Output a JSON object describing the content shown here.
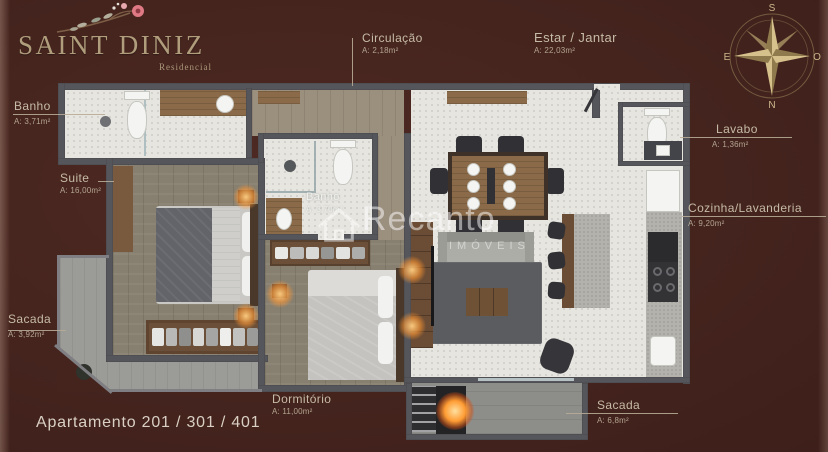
{
  "logo": {
    "title": "SAINT DINIZ",
    "subtitle": "Residencial"
  },
  "compass": {
    "top": "S",
    "left": "E",
    "right": "O",
    "bottom": "N"
  },
  "watermark": {
    "brand": "Recanto",
    "subbrand": "IMÓVEIS"
  },
  "apartment": {
    "label": "Apartamento 201 / 301 / 401"
  },
  "rooms": {
    "banho_suite": {
      "name": "Banho",
      "area": "A: 3,71m²"
    },
    "suite": {
      "name": "Suite",
      "area": "A: 16,00m²"
    },
    "sacada_esquerda": {
      "name": "Sacada",
      "area": "A: 3,92m²"
    },
    "circulacao": {
      "name": "Circulação",
      "area": "A: 2,18m²"
    },
    "estar_jantar": {
      "name": "Estar / Jantar",
      "area": "A: 22,03m²"
    },
    "lavabo": {
      "name": "Lavabo",
      "area": "A: 1,36m²"
    },
    "cozinha_lavanderia": {
      "name": "Cozinha/Lavanderia",
      "area": "A: 9,20m²"
    },
    "banho_social": {
      "name": "Banho",
      "area": "A: 3,70m²"
    },
    "dormitorio": {
      "name": "Dormitório",
      "area": "A: 11,00m²"
    },
    "sacada_churrasqueira": {
      "name": "Sacada",
      "area": "A: 6,8m²"
    }
  },
  "colors": {
    "background": "#45241E",
    "accent_gold": "#AF9D7C",
    "label_tan": "#C6BBA6",
    "wall_gray": "#55565B",
    "wood_floor": "#877F6F",
    "tile": "#E7E5E0",
    "glow_orange": "#FFA04B"
  }
}
